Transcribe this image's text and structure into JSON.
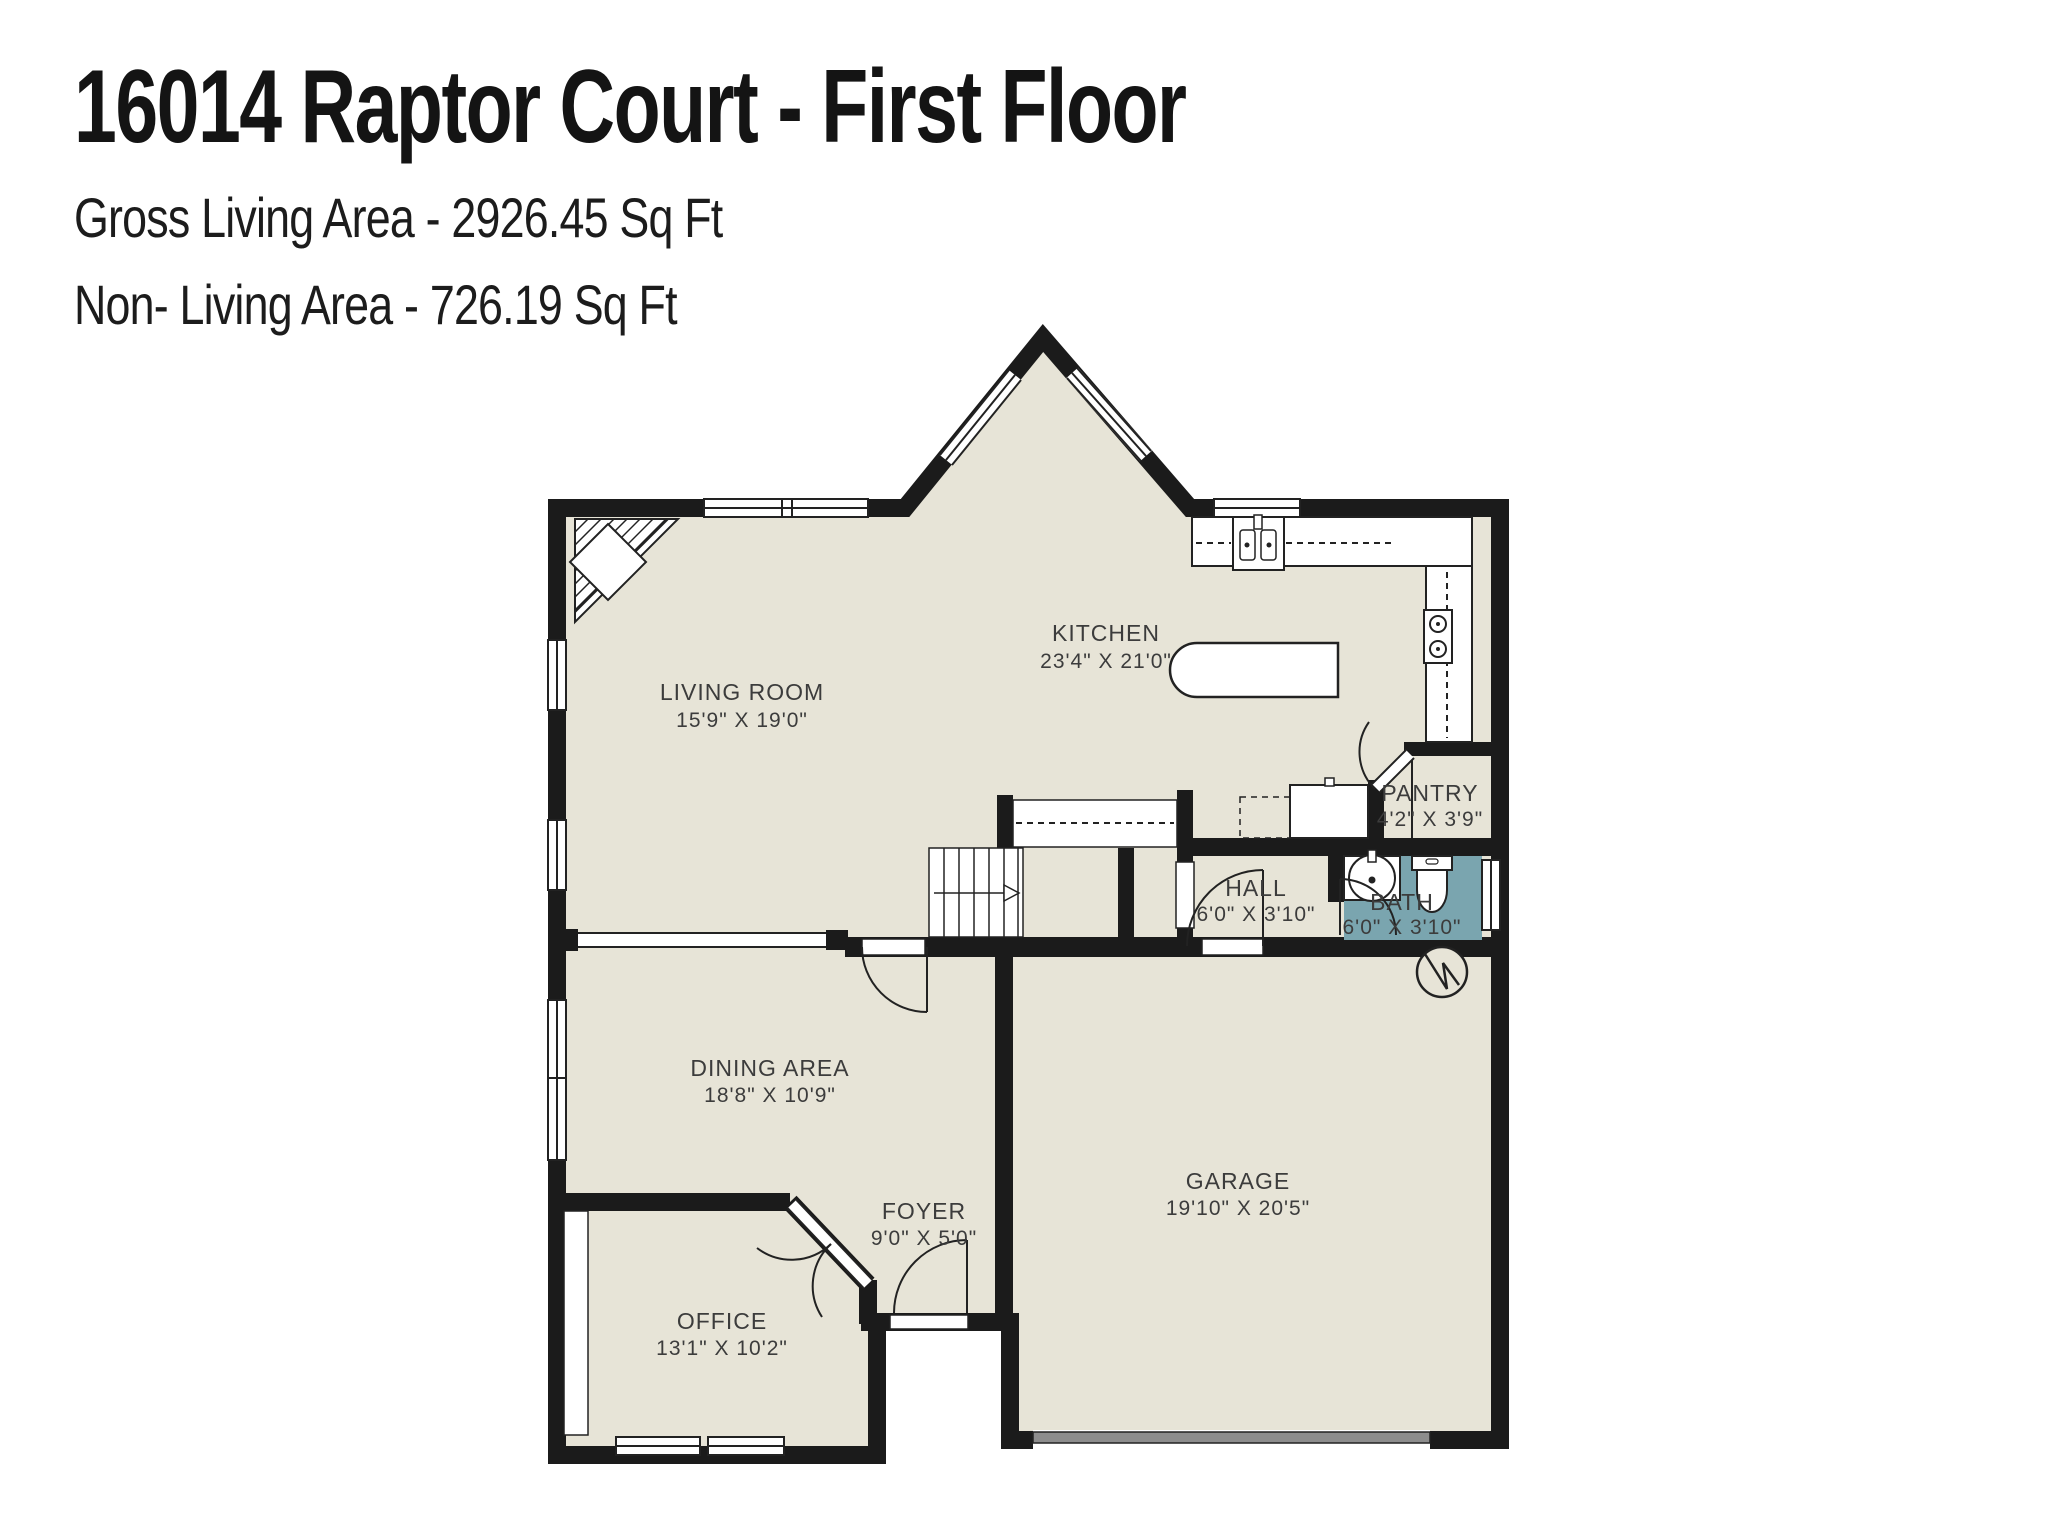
{
  "header": {
    "title": "16014 Raptor Court - First Floor",
    "gross_living_area": "Gross Living Area - 2926.45 Sq Ft",
    "non_living_area": "Non- Living Area - 726.19 Sq Ft"
  },
  "rooms": {
    "living_room": {
      "name": "LIVING ROOM",
      "dims": "15'9\" X 19'0\""
    },
    "kitchen": {
      "name": "KITCHEN",
      "dims": "23'4\" X 21'0\""
    },
    "pantry": {
      "name": "PANTRY",
      "dims": "4'2\" X 3'9\""
    },
    "hall": {
      "name": "HALL",
      "dims": "6'0\" X 3'10\""
    },
    "bath": {
      "name": "BATH",
      "dims": "6'0\" X 3'10\""
    },
    "dining_area": {
      "name": "DINING AREA",
      "dims": "18'8\" X 10'9\""
    },
    "foyer": {
      "name": "FOYER",
      "dims": "9'0\" X 5'0\""
    },
    "office": {
      "name": "OFFICE",
      "dims": "13'1\" X 10'2\""
    },
    "garage": {
      "name": "GARAGE",
      "dims": "19'10\" X 20'5\""
    }
  },
  "icons": {
    "water_heater": "circle-zigzag",
    "stair_direction": "arrow-right",
    "fireplace": "corner-hatch-diamond"
  },
  "colors": {
    "floor": "#e7e4d7",
    "wall": "#1b1b1b",
    "bath_floor": "#7aa5af",
    "garage_door": "#8d8d8d",
    "label_text": "#3c3c3c"
  }
}
